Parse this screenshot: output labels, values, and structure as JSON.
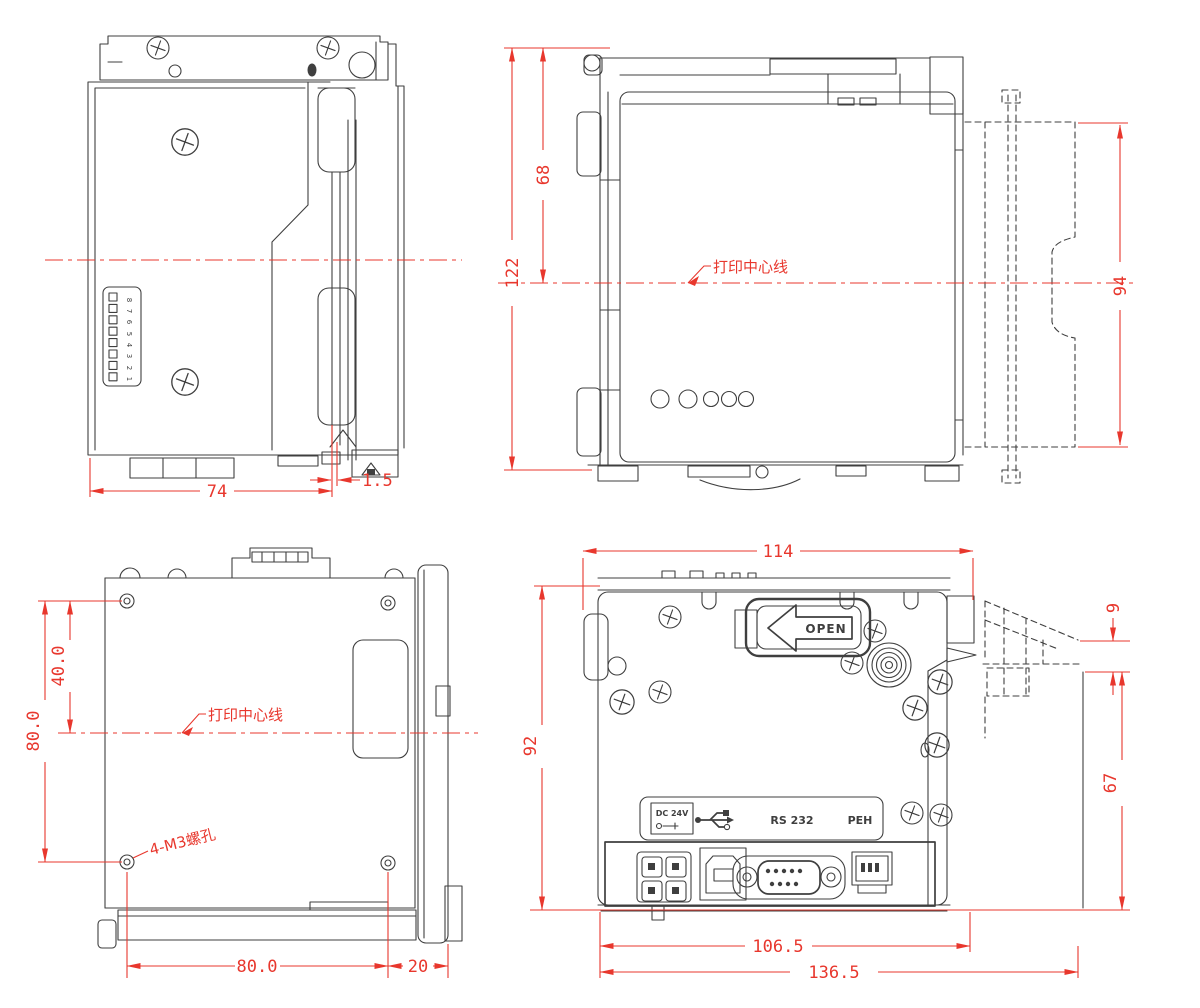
{
  "document": {
    "type": "engineering-dimension-drawing",
    "subject": "kiosk thermal printer module, four orthographic views",
    "units": "mm",
    "colors": {
      "background": "#ffffff",
      "outline": "#3f3f3f",
      "dimension_red": "#e8372d"
    }
  },
  "labels": {
    "print_centerline": "打印中心线",
    "mounting_holes": "4-M3螺孔",
    "open_latch": "OPEN",
    "port_power": "DC 24V",
    "port_serial": "RS 232",
    "port_sensor": "PEH"
  },
  "icons": {
    "usb_port": "usb-trident-icon",
    "open_arrow": "left-arrow-icon",
    "screw": "phillips-screw-icon"
  },
  "views": {
    "side_left": {
      "title": "left side view",
      "dimensions": {
        "body_width": "74",
        "cutter_offset": "1.5"
      },
      "dip_switch": [
        "1",
        "2",
        "3",
        "4",
        "5",
        "6",
        "7",
        "8"
      ]
    },
    "front": {
      "title": "front view",
      "dimensions": {
        "overall_height": "122",
        "top_to_centerline": "68",
        "bezel_height": "94"
      }
    },
    "bottom": {
      "title": "bottom view",
      "dimensions": {
        "centerline_to_hole": "40.0",
        "hole_pitch_vertical": "80.0",
        "hole_pitch_horizontal": "80.0",
        "hole_to_edge": "20"
      }
    },
    "rear": {
      "title": "rear view",
      "dimensions": {
        "body_width": "114",
        "body_height": "92",
        "bezel_lip_depth": "9",
        "bezel_depth": "67",
        "mount_width": "106.5",
        "overall_width": "136.5"
      }
    }
  }
}
